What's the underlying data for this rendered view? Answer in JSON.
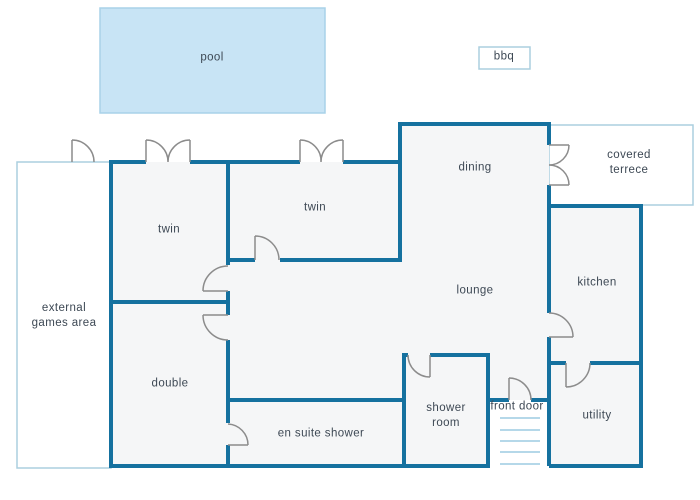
{
  "diagram": {
    "type": "floor plan",
    "colors": {
      "wall": "#15719f",
      "door_arc": "#8c8c8c",
      "room_fill": "#f5f6f7",
      "pool_fill": "#c8e4f5",
      "pool_border": "#a9d2e8",
      "outdoor_border": "#abcfdf",
      "steps": "#b5d8e9",
      "label_text": "#3d4854",
      "outdoor_fill": "#ffffff"
    },
    "labels": {
      "pool": "pool",
      "bbq": "bbq",
      "dining": "dining",
      "covered_terrace": "covered terrece",
      "twin_1": "twin",
      "twin_2": "twin",
      "lounge": "lounge",
      "kitchen": "kitchen",
      "external_games_area": "external\ngames area",
      "double": "double",
      "en_suite_shower": "en suite shower",
      "shower_room": "shower\nroom",
      "front_door": "front door",
      "utility": "utility"
    },
    "features": {
      "entrance_steps_count": 5,
      "door_symbols": [
        "external-games-area-door",
        "twin-1-patio-double-door",
        "twin-2-patio-double-door",
        "covered-terrace-double-door",
        "twin-1-internal-door",
        "twin-2-internal-door",
        "double-room-door",
        "en-suite-door",
        "shower-room-door",
        "kitchen-door",
        "utility-door",
        "front-door"
      ]
    }
  }
}
